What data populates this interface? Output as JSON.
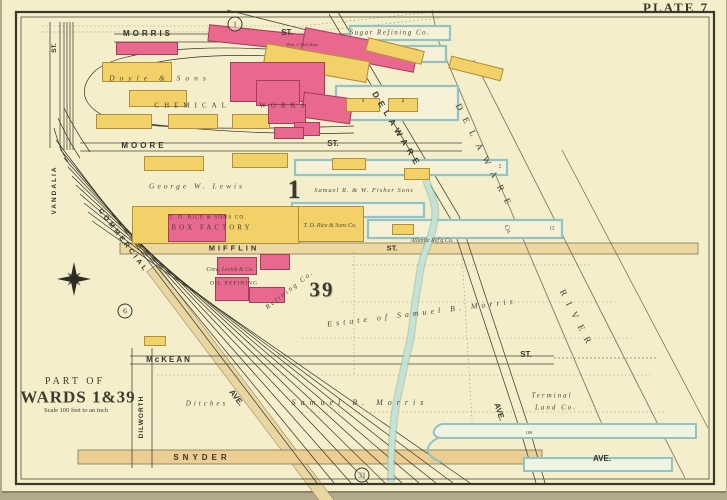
{
  "plate": {
    "label": "PLATE 7",
    "ref_top": "1",
    "ref_left": "6",
    "ref_bottom": "31"
  },
  "title_block": {
    "part_of": "PART OF",
    "wards": "WARDS 1&39",
    "scale": "Scale 100 feet to an inch"
  },
  "wards": {
    "ward_1": "1",
    "ward_39": "39"
  },
  "streets": {
    "morris": "MORRIS",
    "morris_suffix": "ST.",
    "moore": "MOORE",
    "moore_suffix": "ST.",
    "mifflin": "MIFFLIN",
    "mifflin_suffix": "ST.",
    "mckean": "McKEAN",
    "mckean_suffix": "ST.",
    "snyder": "SNYDER",
    "snyder_suffix": "AVE.",
    "delaware_ave": "DELAWARE",
    "delaware_ave_suffix": "AVE.",
    "rr_ave": "AVE.",
    "commercial": "COMMERCIAL",
    "vandalia": "VANDALIA",
    "vandalia_suffix": "ST.",
    "dilworth": "DILWORTH"
  },
  "river": {
    "word1": "DELAWARE",
    "word2": "RIVER",
    "co": "Co."
  },
  "owners": {
    "doyle": "Doyle & Sons",
    "chemical_works": "CHEMICAL WORKS",
    "mccahan": "Wm. J. McCahan",
    "sugar_refining": "Sugar Refining Co.",
    "lewis": "George W. Lewis",
    "fisher": "Samuel R. & W. Fisher Sons",
    "rice_line1": "T. D. RICE & SONS CO.",
    "rice_line2": "BOX FACTORY",
    "rice_lumber": "T. D. Rice & Sons Co.",
    "atlantic": "Atlantic Ref'g Co.",
    "crew_levick": "Crew, Levick & Co.",
    "oil_refining": "OIL REFINING",
    "refining_diag": "Refining Co.",
    "morris_estate": "Estate of Samuel B. Morris",
    "morris_estate2": "Samuel B. Morris",
    "ditches": "Ditches",
    "terminal_line1": "Terminal",
    "terminal_line2": "Land Co."
  },
  "piers": {
    "bldg1": "1",
    "bldg2": "2",
    "pier2": "2",
    "pier12": "12",
    "canal100": "100"
  }
}
